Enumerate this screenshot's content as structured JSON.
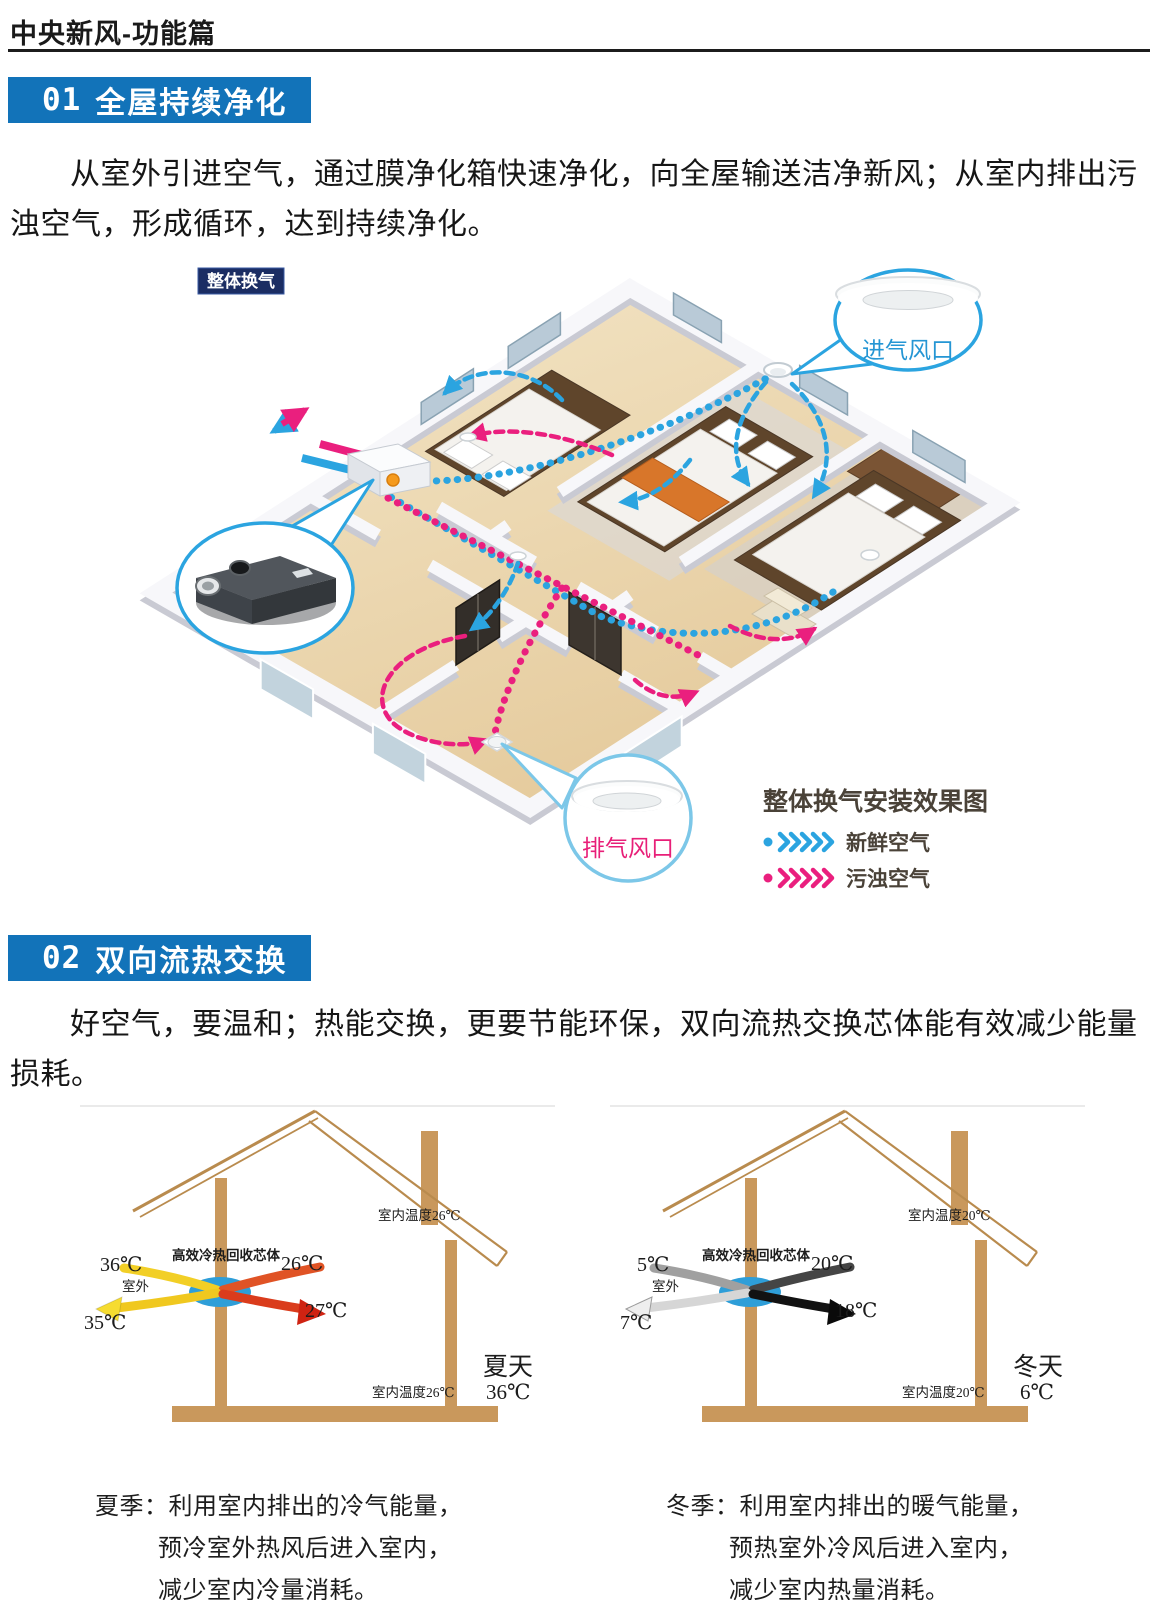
{
  "page": {
    "header": "中央新风-功能篇"
  },
  "colors": {
    "banner_blue": "#1273b9",
    "fresh": "#2ba4e0",
    "polluted": "#ea1f7e",
    "house_tan": "#c9985c",
    "core_blue": "#2e9ed8"
  },
  "section1": {
    "number": "01",
    "title": "全屋持续净化",
    "paragraph": "从室外引进空气，通过膜净化箱快速净化，向全屋输送洁净新风；从室内排出污浊空气，形成循环，达到持续净化。"
  },
  "diagram1": {
    "badge": "整体换气",
    "intake_callout": "进气风口",
    "exhaust_callout": "排气风口",
    "legend_title": "整体换气安装效果图",
    "legend_fresh": "新鲜空气",
    "legend_polluted": "污浊空气"
  },
  "section2": {
    "number": "02",
    "title": "双向流热交换",
    "paragraph": "好空气，要温和；热能交换，更要节能环保，双向流热交换芯体能有效减少能量损耗。"
  },
  "summer": {
    "core_label": "高效冷热回收芯体",
    "roof_label": "室内温度26℃",
    "floor_label": "室内温度26℃",
    "outdoor_label": "室外",
    "temp_in_top": "36℃",
    "temp_out_bottom": "35℃",
    "temp_room_top": "26℃",
    "temp_supply": "27℃",
    "season_name": "夏天",
    "season_temp": "36℃",
    "arrows": {
      "a1": "#f2cf26",
      "a2": "#f0c81f",
      "head_left": "#f6dc30",
      "b1": "#e05325",
      "b2": "#da3c1c",
      "head_right": "#cf2312"
    },
    "caption": [
      "夏季：利用室内排出的冷气能量，",
      "预冷室外热风后进入室内，",
      "减少室内冷量消耗。"
    ]
  },
  "winter": {
    "core_label": "高效冷热回收芯体",
    "roof_label": "室内温度20℃",
    "floor_label": "室内温度20℃",
    "outdoor_label": "室外",
    "temp_in_top": "5℃",
    "temp_out_bottom": "7℃",
    "temp_room_top": "20℃",
    "temp_supply": "18℃",
    "season_name": "冬天",
    "season_temp": "6℃",
    "arrows": {
      "a1": "#a0a0a0",
      "a2": "#d6d6d6",
      "head_left": "#eeeeee",
      "b1": "#454545",
      "b2": "#121212",
      "head_right": "#0a0a0a"
    },
    "caption": [
      "冬季：利用室内排出的暖气能量，",
      "预热室外冷风后进入室内，",
      "减少室内热量消耗。"
    ]
  }
}
